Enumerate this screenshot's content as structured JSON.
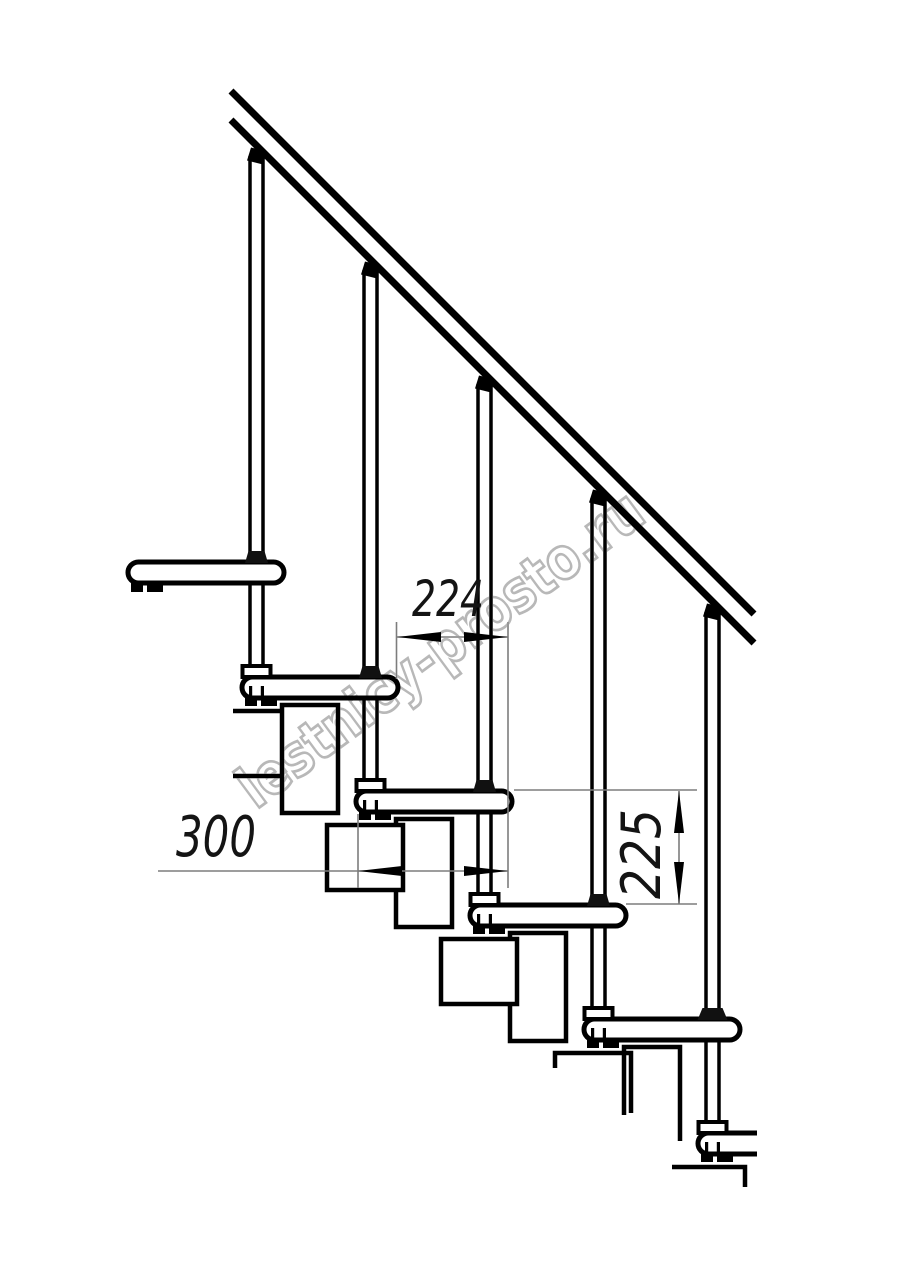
{
  "drawing": {
    "title": "modular-staircase-side-view",
    "watermark": {
      "text": "lestnicy-prosto.ru",
      "color": "#b8b8b8"
    },
    "dimensions": {
      "run_label": "224",
      "depth_label": "300",
      "rise_label": "225"
    },
    "colors": {
      "line": "#000000",
      "dim_line": "#7d7d7d",
      "dim_text": "#141414"
    }
  }
}
